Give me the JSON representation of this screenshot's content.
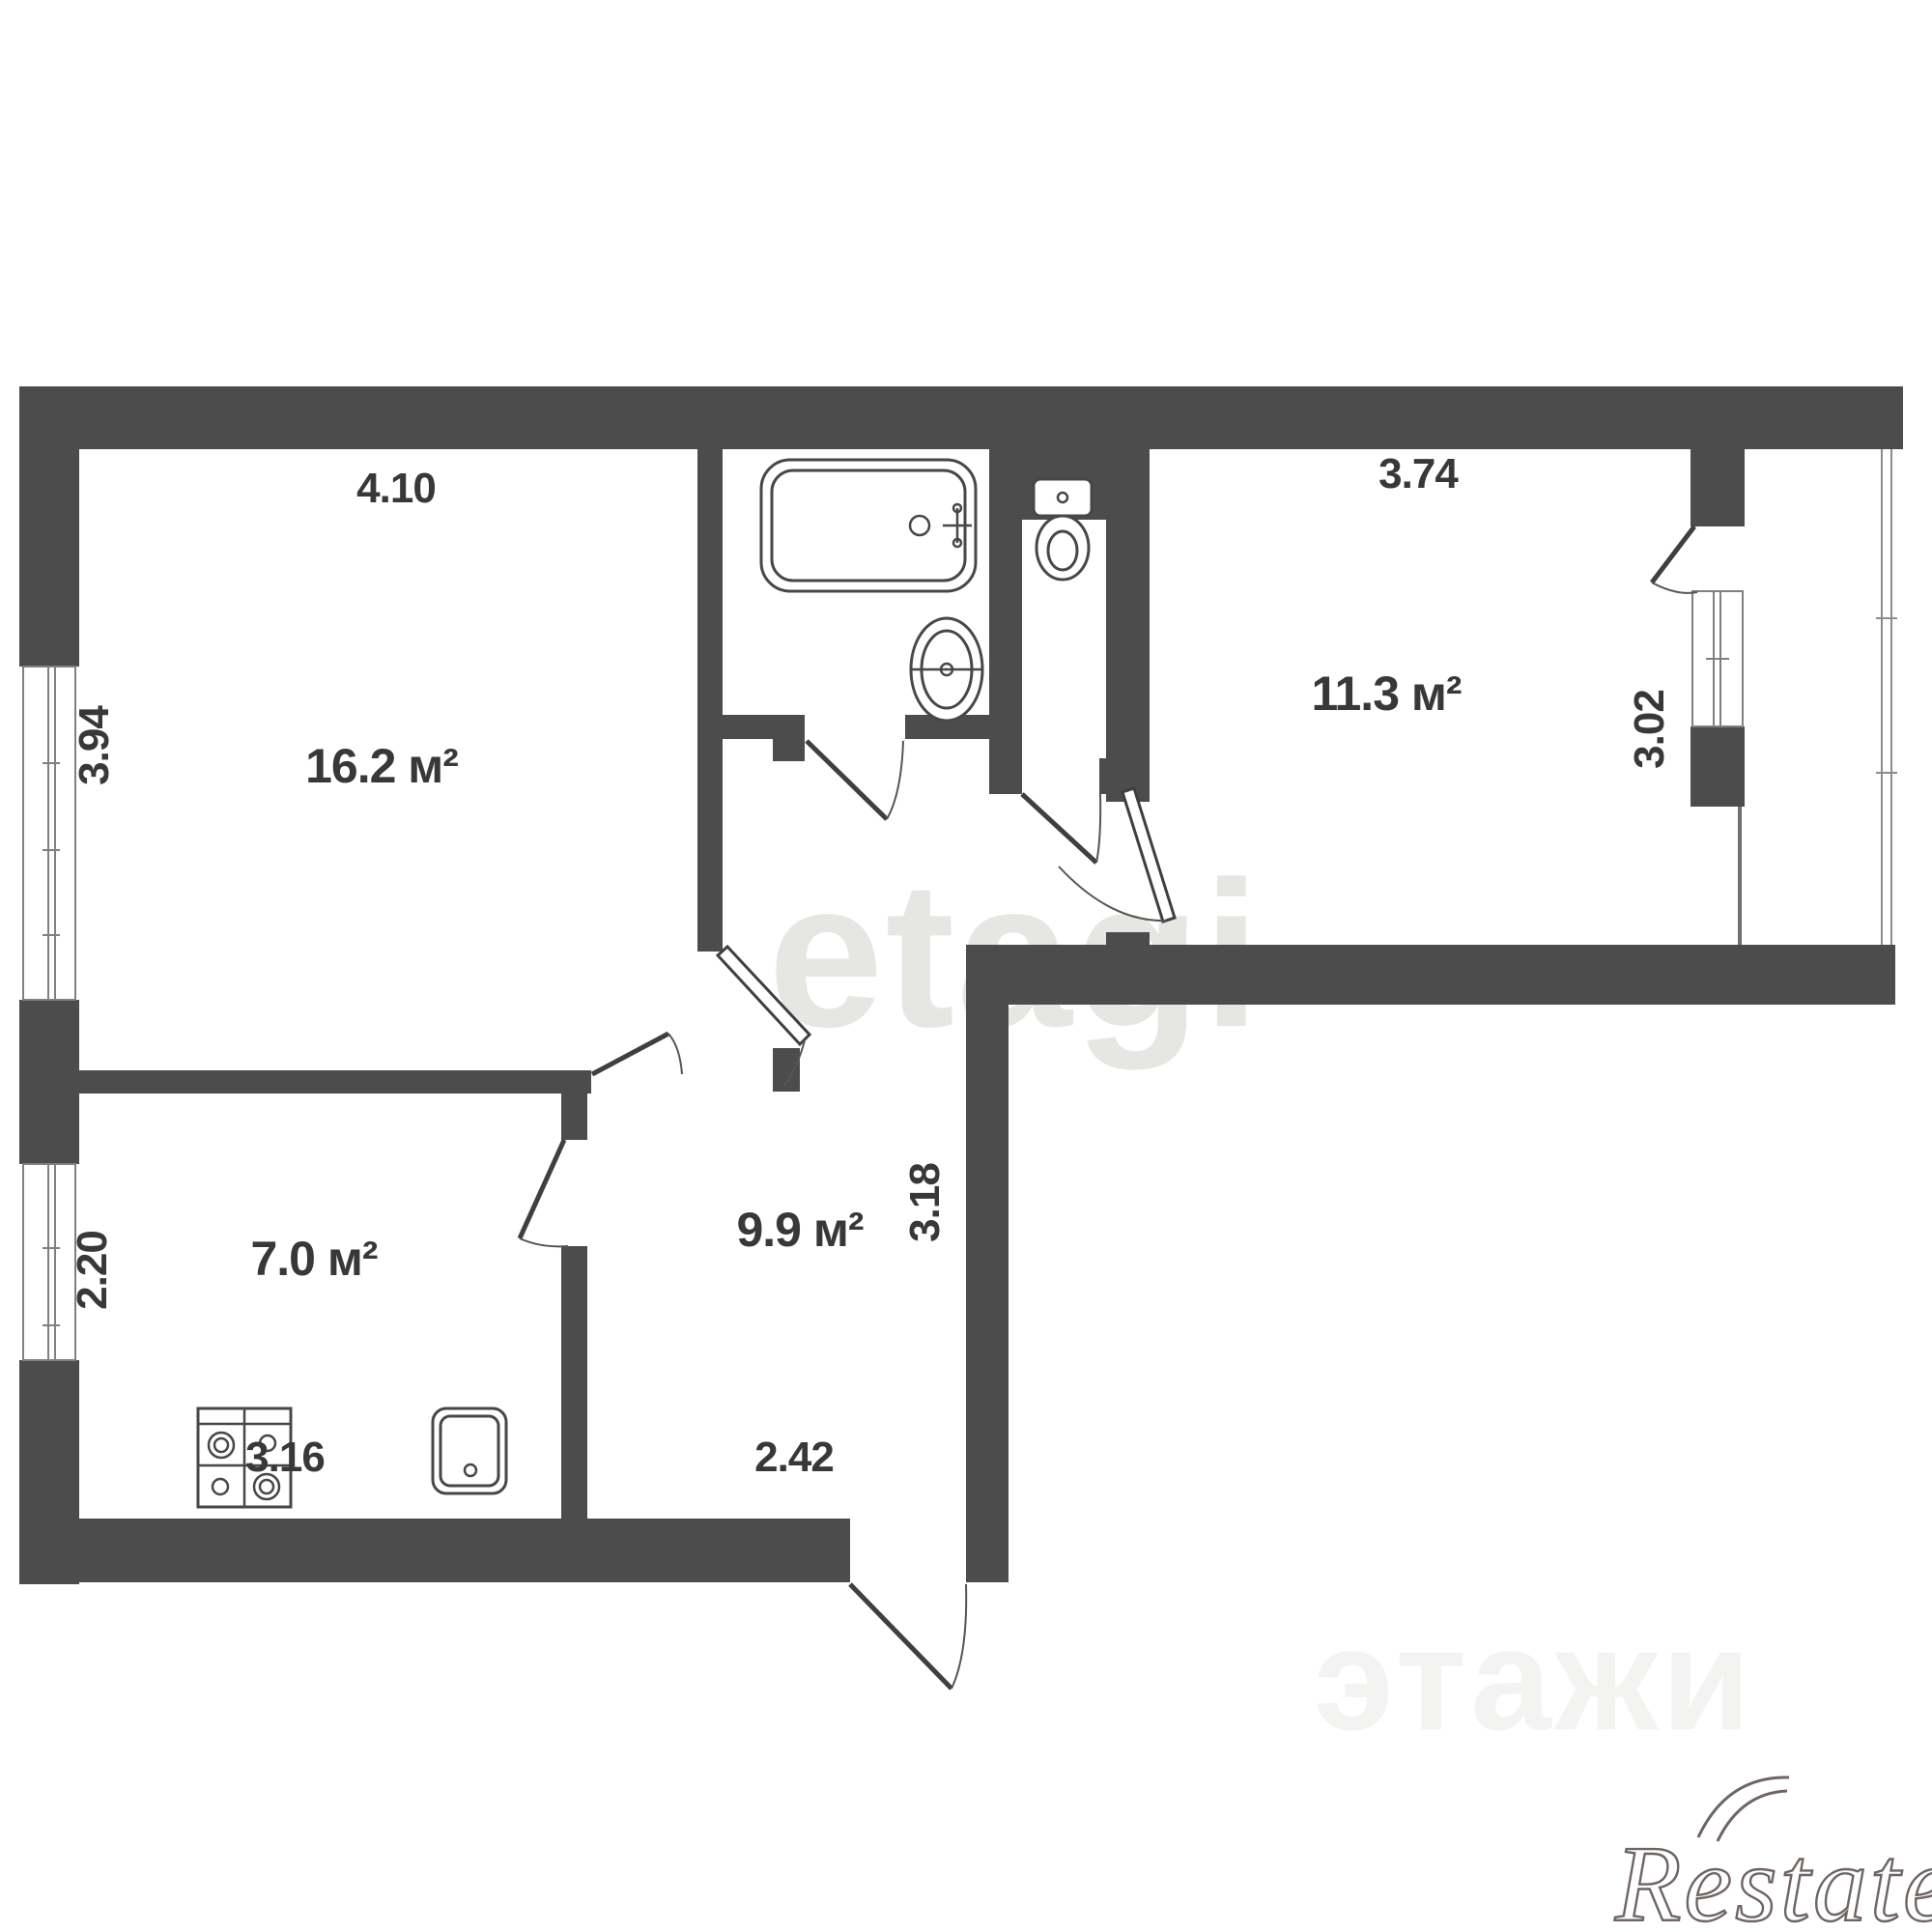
{
  "title": "2-room apartment floor plan",
  "colors": {
    "wall": "#4c4c4c",
    "fixture_line": "#474747",
    "label": "#383838",
    "watermark_center": "#e6e6e3",
    "watermark_faint": "#ebebe8",
    "brand_logo": "#6e6563",
    "background": "#ffffff"
  },
  "rooms": [
    {
      "name": "living-room",
      "area": "16.2 м²",
      "dims": {
        "top": "4.10",
        "left": "3.94"
      }
    },
    {
      "name": "bedroom",
      "area": "11.3 м²",
      "dims": {
        "top": "3.74",
        "right": "3.02"
      }
    },
    {
      "name": "kitchen",
      "area": "7.0 м²",
      "dims": {
        "left": "2.20",
        "bottom": "3.16"
      }
    },
    {
      "name": "hallway",
      "area": "9.9 м²",
      "dims": {
        "right": "3.18",
        "bottom": "2.42"
      }
    }
  ],
  "fixtures": [
    "bathtub",
    "bathroom-sink",
    "toilet",
    "stove",
    "kitchen-sink"
  ],
  "watermarks": {
    "center": "etagi",
    "bottom_faint": "этажи",
    "brand": "Restate"
  }
}
